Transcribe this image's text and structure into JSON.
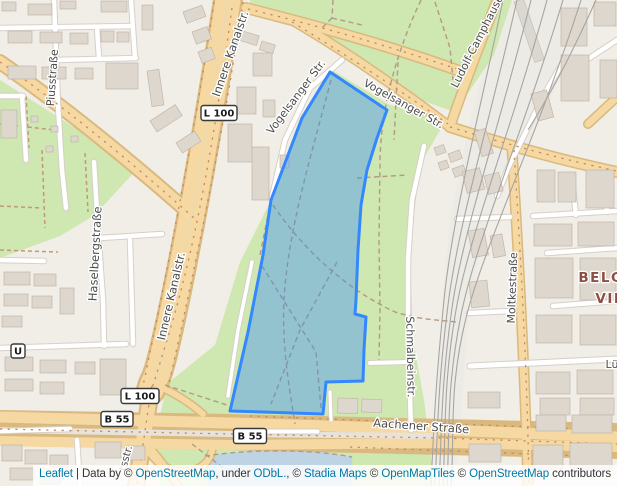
{
  "map": {
    "background": "#f1eee8",
    "park_green": "#cfe7b0",
    "water": "#bed3e4",
    "road_primary_fill": "#f6d9a2",
    "road_primary_casing": "#d9b97e",
    "street_labels": [
      {
        "name": "label-piusstrasse",
        "text": "Piusstraße",
        "x": 56,
        "y": 78,
        "rotate": -86,
        "size": 11,
        "kind": "street"
      },
      {
        "name": "label-innere-kanalstr-north",
        "text": "Innere Kanalstr.",
        "x": 234,
        "y": 55,
        "rotate": -71,
        "size": 11.5,
        "kind": "street"
      },
      {
        "name": "label-innere-kanalstr-south",
        "text": "Innere Kanalstr.",
        "x": 175,
        "y": 297,
        "rotate": -77,
        "size": 11.5,
        "kind": "street"
      },
      {
        "name": "label-vogelsanger-str-west",
        "text": "Vogelsanger Str.",
        "x": 299,
        "y": 99,
        "rotate": -53,
        "size": 11,
        "kind": "street"
      },
      {
        "name": "label-vogelsanger-str-east",
        "text": "Vogelsanger Str.",
        "x": 402,
        "y": 107,
        "rotate": 29,
        "size": 11,
        "kind": "street"
      },
      {
        "name": "label-ludolf-camphausen-str",
        "text": "Ludolf-Camphausen-Str.",
        "x": 487,
        "y": 30,
        "rotate": -63,
        "size": 11,
        "kind": "street"
      },
      {
        "name": "label-haselbergstrasse",
        "text": "Haselbergstraße",
        "x": 99,
        "y": 254,
        "rotate": -87,
        "size": 11.5,
        "kind": "street"
      },
      {
        "name": "label-schmalbeinstr",
        "text": "Schmalbeinstr.",
        "x": 407,
        "y": 357,
        "rotate": 89,
        "size": 11,
        "kind": "street"
      },
      {
        "name": "label-moltkestrasse",
        "text": "Moltkestraße",
        "x": 516,
        "y": 288,
        "rotate": -88,
        "size": 11,
        "kind": "street"
      },
      {
        "name": "label-aachener-strasse",
        "text": "Aachener Straße",
        "x": 421,
        "y": 430,
        "rotate": 4,
        "size": 11.5,
        "kind": "street"
      },
      {
        "name": "label-district-belgisches",
        "text": "BELG",
        "x": 601,
        "y": 282,
        "rotate": 0,
        "size": 13.5,
        "kind": "district"
      },
      {
        "name": "label-district-viertel",
        "text": "VIE",
        "x": 610,
        "y": 303,
        "rotate": 0,
        "size": 13.5,
        "kind": "district"
      },
      {
        "name": "label-luetticher-str-partial",
        "text": "Lü",
        "x": 612,
        "y": 368,
        "rotate": 0,
        "size": 11,
        "kind": "street"
      },
      {
        "name": "label-tsstr-partial",
        "text": "tsstr.",
        "x": 129,
        "y": 459,
        "rotate": -75,
        "size": 10.5,
        "kind": "street"
      }
    ],
    "road_badges": [
      {
        "name": "badge-l100-north",
        "text": "L 100",
        "x": 219,
        "y": 113,
        "w": 36,
        "h": 15
      },
      {
        "name": "badge-l100-south",
        "text": "L 100",
        "x": 140,
        "y": 396,
        "w": 38,
        "h": 15
      },
      {
        "name": "badge-b55-west",
        "text": "B 55",
        "x": 117,
        "y": 419,
        "w": 32,
        "h": 15
      },
      {
        "name": "badge-b55-east",
        "text": "B 55",
        "x": 250,
        "y": 436,
        "w": 33,
        "h": 15
      },
      {
        "name": "badge-ubahn-station",
        "text": "U",
        "x": 18,
        "y": 351,
        "w": 14,
        "h": 14
      }
    ]
  },
  "overlay": {
    "stroke": "#3388ff",
    "stroke_width": 3,
    "fill": "#3388ff",
    "fill_opacity": 0.38,
    "points": "330,72 387,110 377,138 367,170 361,205 358,250 356,300 355,314 366,317 364,350 363,381 326,382 323,414 230,411 248,332 263,255 271,200 302,118"
  },
  "attribution": {
    "parts": [
      {
        "text": "Leaflet",
        "link": true
      },
      {
        "text": " | Data by © ",
        "link": false
      },
      {
        "text": "OpenStreetMap",
        "link": true
      },
      {
        "text": ", under ",
        "link": false
      },
      {
        "text": "ODbL.",
        "link": true
      },
      {
        "text": ", © ",
        "link": false
      },
      {
        "text": "Stadia Maps",
        "link": true
      },
      {
        "text": " © ",
        "link": false
      },
      {
        "text": "OpenMapTiles",
        "link": true
      },
      {
        "text": " © ",
        "link": false
      },
      {
        "text": "OpenStreetMap",
        "link": true
      },
      {
        "text": " contributors",
        "link": false
      }
    ]
  }
}
